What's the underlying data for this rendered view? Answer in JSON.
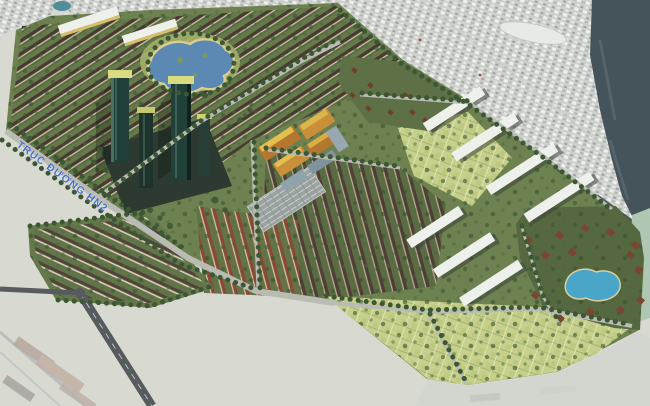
{
  "image": {
    "road_label": "TRỤC ĐƯỜNG HN2"
  },
  "colors": {
    "base_land": "#d8dad1",
    "city": "#cdd0cc",
    "river": "#45535a",
    "sea_green": "#aec6b2",
    "development_green": "#6e8150",
    "tree_green": "#3c5733",
    "roof_dark": "#473a31",
    "roof_dark_b": "#4e3e35",
    "roof_red": "#8a4836",
    "lake_blue": "#5b89b4",
    "pool_blue": "#4aa6c8",
    "tower_glass": "#21403a",
    "tower_roof": "#d9dc7e",
    "orange_block": "#c98f3a",
    "white_slab": "#eef0ec",
    "field_green": "#c6d08c",
    "road_light": "#b8bcb3",
    "road_dark": "#565b5e",
    "label_blue": "#4a6fc4"
  }
}
